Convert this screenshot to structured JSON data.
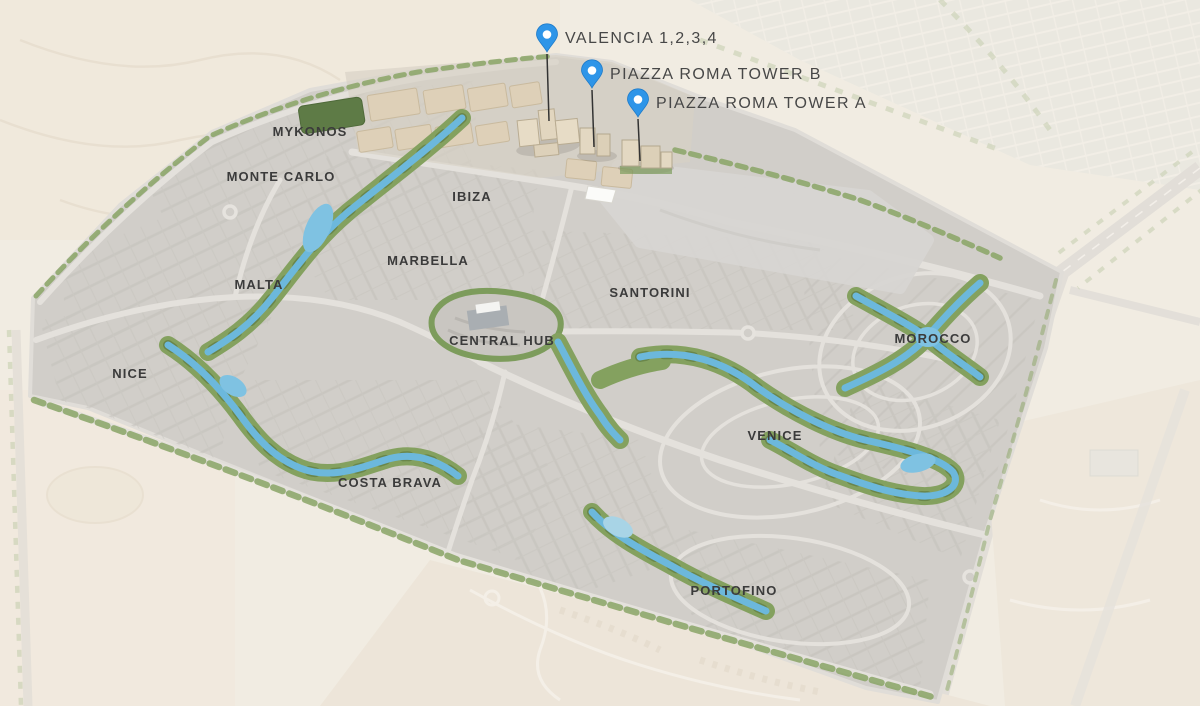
{
  "map": {
    "name": "Master plan map",
    "development_labels_note": "district names rendered on plan"
  },
  "pins": [
    {
      "id": "valencia",
      "label": "VALENCIA 1,2,3,4",
      "icon": "map-pin-icon",
      "color": "#2e95e8"
    },
    {
      "id": "piazza-roma-tower-b",
      "label": "PIAZZA ROMA TOWER B",
      "icon": "map-pin-icon",
      "color": "#2e95e8"
    },
    {
      "id": "piazza-roma-tower-a",
      "label": "PIAZZA ROMA TOWER A",
      "icon": "map-pin-icon",
      "color": "#2e95e8"
    }
  ],
  "districts": [
    {
      "name": "MYKONOS"
    },
    {
      "name": "MONTE CARLO"
    },
    {
      "name": "IBIZA"
    },
    {
      "name": "MARBELLA"
    },
    {
      "name": "MALTA"
    },
    {
      "name": "SANTORINI"
    },
    {
      "name": "CENTRAL HUB"
    },
    {
      "name": "NICE"
    },
    {
      "name": "MOROCCO"
    },
    {
      "name": "VENICE"
    },
    {
      "name": "COSTA BRAVA"
    },
    {
      "name": "PORTOFINO"
    }
  ],
  "colors": {
    "pin_blue": "#2e95e8",
    "lagoon_blue": "#6cb8dc",
    "lagoon_light": "#9ed3ea",
    "vegetation_green": "#7f9e5a",
    "development_gray": "#d1cec9",
    "label_dark": "#3b3b3b"
  }
}
